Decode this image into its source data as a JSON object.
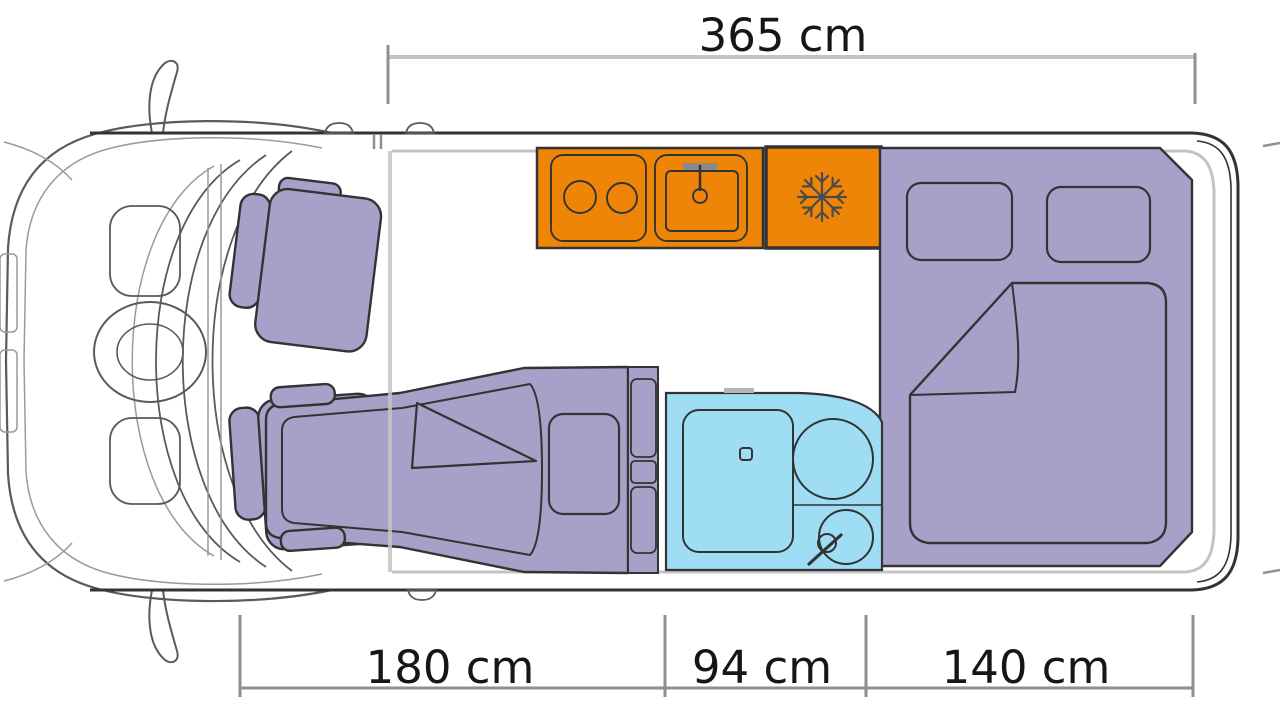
{
  "dimensions": {
    "top": {
      "label": "365 cm"
    },
    "bottom": [
      {
        "label": "180 cm"
      },
      {
        "label": "94 cm"
      },
      {
        "label": "140 cm"
      }
    ]
  },
  "colors": {
    "kitchen": "#EF8507",
    "furniture": "#A7A1CA",
    "bathroom": "#9EDDF4",
    "outline": "#333333",
    "cabline": "#5a5a5a",
    "wall": "#c3c3c3",
    "dimline": "#8f8f8f",
    "text": "#161616"
  }
}
